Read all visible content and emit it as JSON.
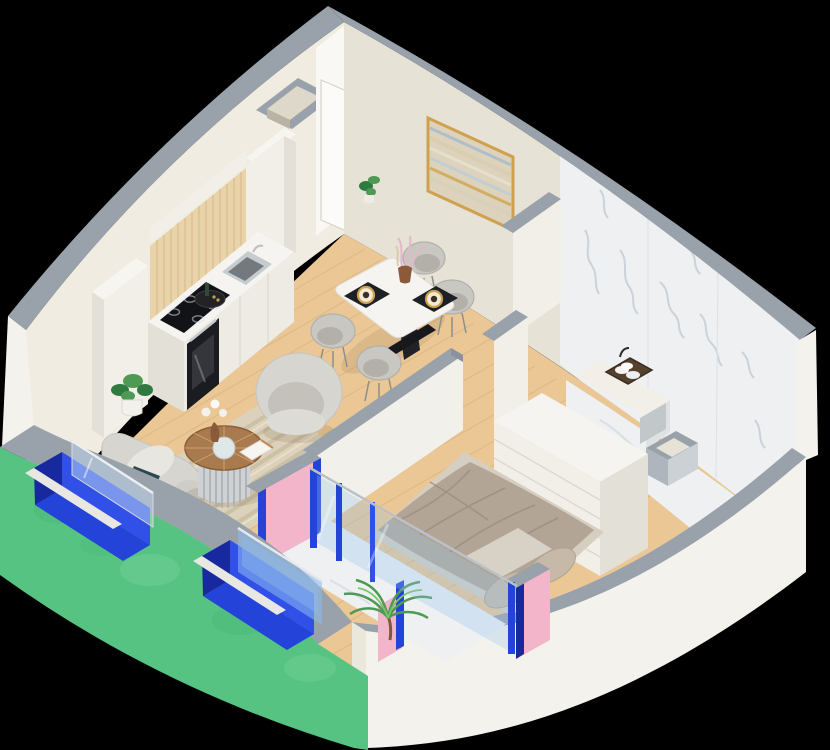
{
  "scene": {
    "label": "3D isometric cutaway floor-plan render of a one-bedroom apartment on a black background",
    "width": 830,
    "height": 750,
    "background": "#000000"
  },
  "colors": {
    "bg": "#000000",
    "wall_top": "#99a1aa",
    "wall_top_dark": "#8a92a0",
    "wall_nw": "#f0ece2",
    "wall_ne": "#e7e2d6",
    "wall_inner_se": "#eae7db",
    "wall_exterior": "#f4f2ec",
    "green": "#56c382",
    "green_dark": "#2f9a5f",
    "green_light": "#a8e8c4",
    "blue": "#2443d8",
    "blue_dark": "#18289e",
    "blue_mid": "#3050e8",
    "glass": "#8fb8e8",
    "pink": "#f3b5ca",
    "wood_floor": "#eac795",
    "wood_line": "#d9b582",
    "oak": "#e8d4a8",
    "oak_line": "#d8bf92",
    "marble": "#eef0f2",
    "marble_vein": "#b6bec9",
    "white_unit": "#f1efe8",
    "white_unit_shade": "#e3e0d7",
    "counter_front": "#edebe4",
    "appliance_black": "#1b1c1f",
    "cooktop_black": "#121316",
    "steel": "#c6cbd0",
    "steel_dark": "#74797e",
    "gold": "#cfa14f",
    "art_base": "#ddd3bd",
    "chair_gray": "#c9c7c1",
    "chair_gray_dark": "#b2b0aa",
    "sofa": "#d7d5cf",
    "teal": "#2c4852",
    "rug": "#dcd2bc",
    "rug_stripe": "#ccc0a6",
    "table_white": "#f6f4f0",
    "black": "#17181b",
    "bed": "#b2a595",
    "bed_shade": "#9a8d7d",
    "sheet": "#d8d2c6",
    "pillow": "#c6b9a8",
    "plant": "#4e9a55",
    "plant_dark": "#2f7a40",
    "door": "#fcfbf9",
    "terra": "#a97a4e"
  },
  "inventory": {
    "architecture": [
      "green-curved-exterior-wall",
      "two-blue-window-recesses",
      "glass-panes",
      "white-cut-exterior-wall",
      "cream-back-walls",
      "gray-wall-caps",
      "white-entrance-door",
      "wall-duct-opening",
      "framed-abstract-painting",
      "marble-bathroom-walls"
    ],
    "kitchen": [
      "tall-white-cabinets",
      "oak-upper-panel",
      "white-countertop",
      "black-induction-cooktop",
      "stainless-sink",
      "built-in-oven",
      "round-serving-tray",
      "potted-plant"
    ],
    "dining": [
      "white-dining-table",
      "black-table-base",
      "four-gray-shell-chairs",
      "two-dark-placemats",
      "gold-rimmed-plates",
      "vase-with-pink-pampas"
    ],
    "living": [
      "gray-sofa",
      "teal-cushion",
      "striped-beige-rug",
      "round-wood-coffee-table",
      "white-flower-vase",
      "book",
      "gray-armchair"
    ],
    "balcony": [
      "pink-accent-walls",
      "blue-window-mullions",
      "glass-partition",
      "palm-plant",
      "marble-floor"
    ],
    "bedroom": [
      "double-bed-taupe-bedding",
      "two-pillows",
      "white-dresser"
    ],
    "bathroom": [
      "marble-floor",
      "vanity-counter",
      "towel-basket",
      "faucet",
      "duct-shaft"
    ]
  }
}
